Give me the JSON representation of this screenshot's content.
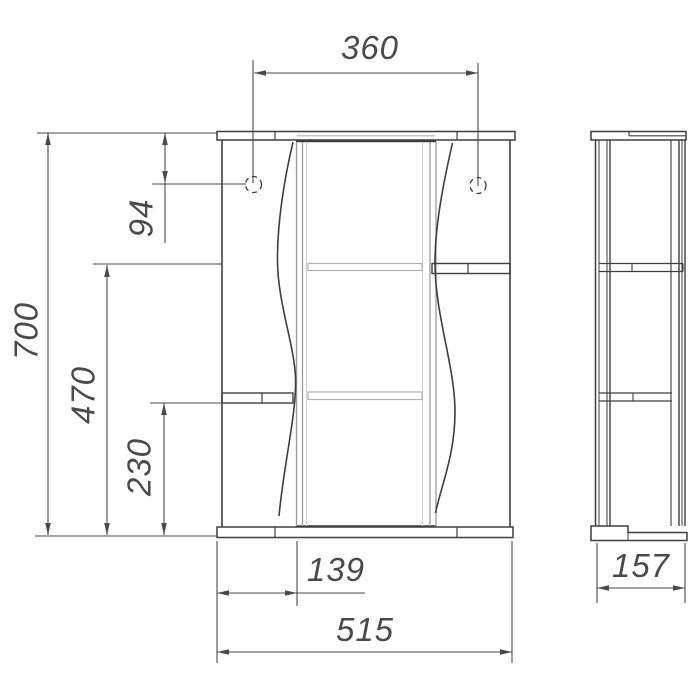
{
  "drawing": {
    "type": "technical-dimension-drawing",
    "subject": "mirror-cabinet-front-and-side-views",
    "dimensions": {
      "top_width": "360",
      "hole_offset": "94",
      "overall_height": "700",
      "right_shelf_height": "470",
      "left_shelf_height": "230",
      "left_section_width": "139",
      "overall_width": "515",
      "depth": "157"
    },
    "colors": {
      "line": "#3e3e3e",
      "dim_line": "#4a4a4a",
      "light_line": "#b0b0b0",
      "text": "#4a4a4a",
      "background": "#ffffff"
    },
    "icons": {
      "mounting_hole": "dashed-circle"
    }
  }
}
